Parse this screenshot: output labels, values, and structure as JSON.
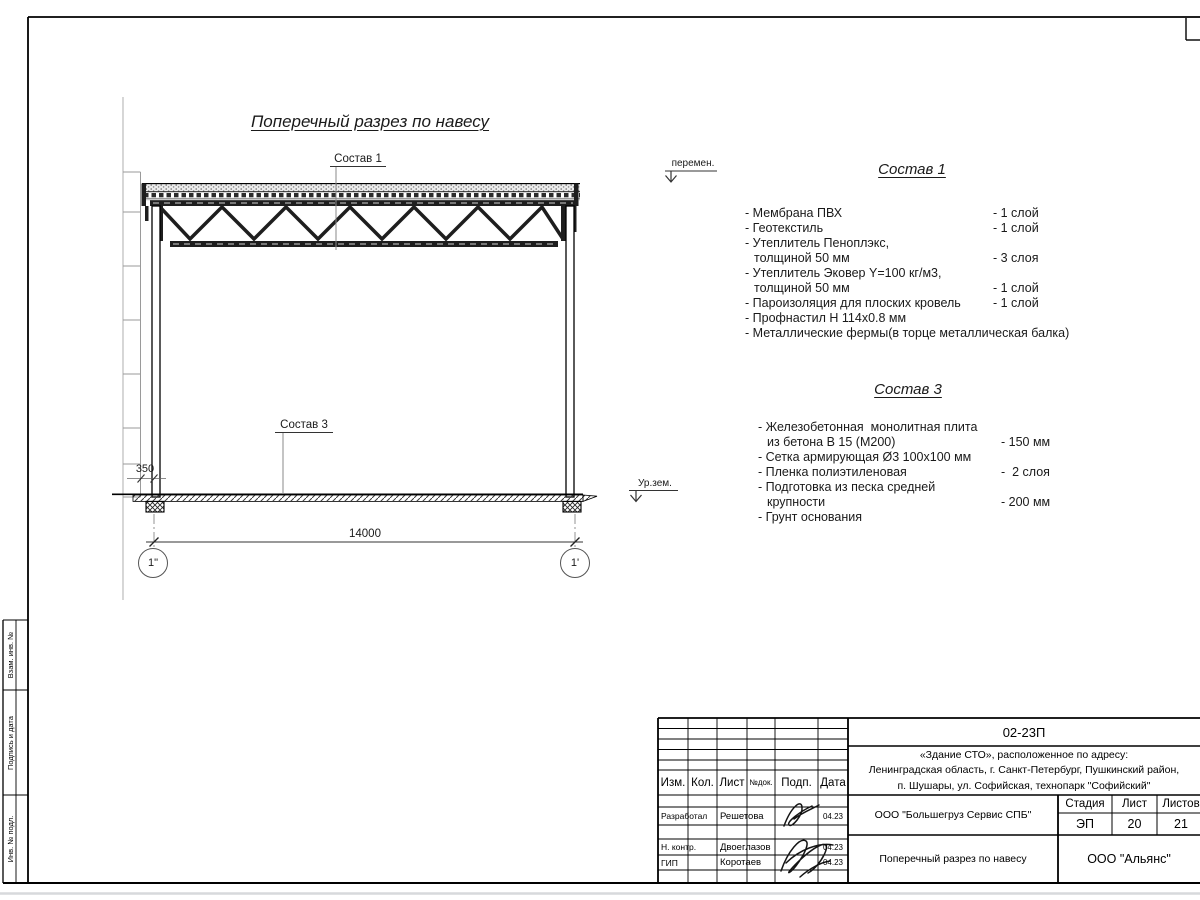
{
  "drawing": {
    "title": "Поперечный разрез по навесу",
    "callout_1": "Состав 1",
    "callout_3": "Состав 3",
    "dim_span": "14000",
    "dim_offset": "350",
    "axis_left": "1\"",
    "axis_right": "1'",
    "level_top": "перемен.",
    "level_ground": "Ур.зем."
  },
  "sostav1": {
    "title": "Состав 1",
    "lines": [
      {
        "text": "- Мембрана ПВХ",
        "value": "- 1 слой"
      },
      {
        "text": "- Геотекстиль",
        "value": "- 1 слой"
      },
      {
        "text": "- Утеплитель Пеноплэкс,",
        "value": ""
      },
      {
        "text": "толщиной 50 мм",
        "value": "- 3 слоя"
      },
      {
        "text": "- Утеплитель Эковер Y=100 кг/м3,",
        "value": ""
      },
      {
        "text": "толщиной 50 мм",
        "value": "- 1 слой"
      },
      {
        "text": "- Пароизоляция для плоских кровель",
        "value": "- 1 слой"
      },
      {
        "text": "- Профнастил Н 114х0.8 мм",
        "value": ""
      },
      {
        "text": "- Металлические фермы(в торце металлическая балка)",
        "value": ""
      }
    ]
  },
  "sostav3": {
    "title": "Состав 3",
    "lines": [
      {
        "text": "- Железобетонная  монолитная плита",
        "value": ""
      },
      {
        "text": "из бетона В 15 (М200)",
        "value": "- 150 мм"
      },
      {
        "text": "- Сетка армирующая Ø3 100х100 мм",
        "value": ""
      },
      {
        "text": "- Пленка полиэтиленовая",
        "value": "-  2 слоя"
      },
      {
        "text": "- Подготовка из песка средней",
        "value": ""
      },
      {
        "text": "крупности",
        "value": "- 200 мм"
      },
      {
        "text": "- Грунт основания",
        "value": ""
      }
    ]
  },
  "titleblock": {
    "doc_number": "02-23П",
    "object_lines": [
      "«Здание СТО», расположенное по адресу:",
      "Ленинградская область, г. Санкт-Петербург, Пушкинский район,",
      "п. Шушары, ул. Софийская, технопарк \"Софийский\""
    ],
    "columns": {
      "izm": "Изм.",
      "kol": "Кол.",
      "list": "Лист",
      "ndok": "№док.",
      "podp": "Подп.",
      "data": "Дата"
    },
    "people": [
      {
        "role": "Разработал",
        "name": "Решетова",
        "date": "04.23"
      },
      {
        "role": "Н. контр.",
        "name": "Двоеглазов",
        "date": "04.23"
      },
      {
        "role": "ГИП",
        "name": "Коротаев",
        "date": "04.23"
      }
    ],
    "company": "ООО \"Большегруз Сервис СПБ\"",
    "stage_label": "Стадия",
    "sheet_label": "Лист",
    "sheets_label": "Листов",
    "stage": "ЭП",
    "sheet_no": "20",
    "sheets_total": "21",
    "doc_title": "Поперечный разрез по навесу",
    "org": "ООО \"Альянс\""
  },
  "margin": {
    "labels": [
      "Взам. инв. №",
      "Подпись и дата",
      "Инв. № подл."
    ]
  }
}
